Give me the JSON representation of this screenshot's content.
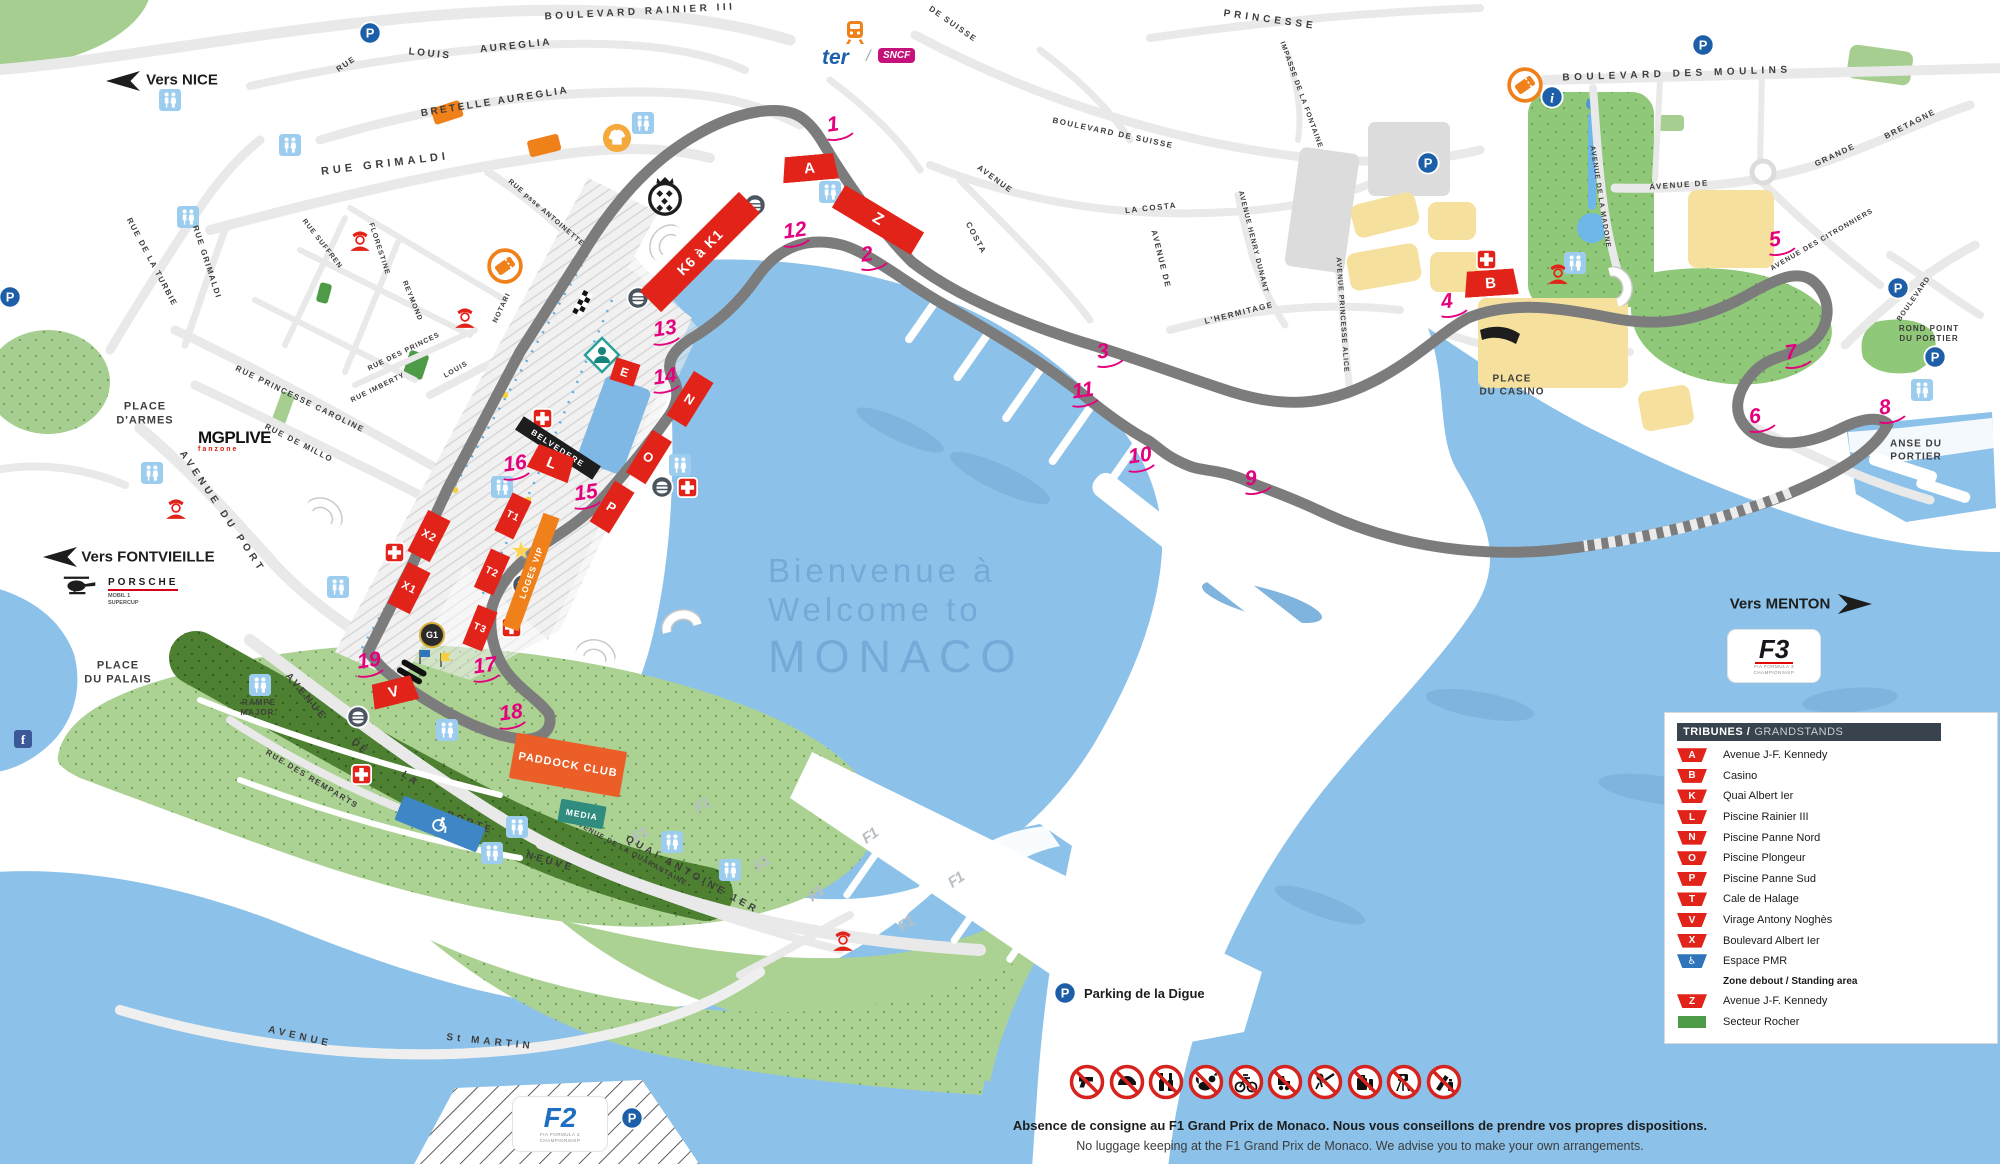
{
  "welcome": {
    "line1": "Bienvenue à",
    "line2": "Welcome to",
    "line3": "MONACO"
  },
  "directions": {
    "nice": "Vers NICE",
    "fontvieille": "Vers FONTVIEILLE",
    "menton": "Vers MENTON"
  },
  "streets": {
    "rainier": "BOULEVARD RAINIER III",
    "rue": "RUE",
    "louis": "LOUIS",
    "aureglia": "AUREGLIA",
    "bretelle": "BRETELLE AUREGLIA",
    "grimaldi": "RUE GRIMALDI",
    "turbie": "RUE DE LA TURBIE",
    "grimaldi2": "RUE GRIMALDI",
    "suffren": "RUE SUFFREN",
    "florestine": "FLORESTINE",
    "reymond": "REYMOND",
    "antoinette": "RUE psse ANTOINETTE",
    "louis2": "LOUIS",
    "notari": "NOTARI",
    "princes": "RUE DES PRINCES",
    "imberty": "RUE IMBERTY",
    "caroline": "RUE PRINCESSE CAROLINE",
    "millo": "RUE DE MILLO",
    "port": "AVENUE DU PORT",
    "porteneuve1": "AVENUE",
    "porteneuve2": "DE",
    "porteneuve3": "LA",
    "porteneuve4": "PORTE",
    "porteneuve5": "NEUVE",
    "remparts": "RUE DES REMPARTS",
    "quai": "QUAI ANTOINE 1ER",
    "quarantaine": "AVENUE DE LA QUARANTAINE",
    "avenue2": "AVENUE",
    "stmartin": "St MARTIN",
    "princesse": "PRINCESSE",
    "impasse": "IMPASSE DE LA FONTAINE",
    "suisse1": "DE SUISSE",
    "suisse2": "BOULEVARD DE SUISSE",
    "costa_av": "AVENUE",
    "costa": "COSTA",
    "lacosta": "LA COSTA",
    "avenuede": "AVENUE DE",
    "dunant": "AVENUE HENRY DUNANT",
    "hermitage": "L'HERMITAGE",
    "alice": "AVENUE PRINCESSE ALICE",
    "moulins": "BOULEVARD DES MOULINS",
    "madone": "AVENUE DE LA MADONE",
    "avenuede2": "AVENUE DE",
    "grande": "GRANDE",
    "bretagne": "BRETAGNE",
    "citronniers": "AVENUE DES CITRONNIERS",
    "larvotto": "BOULEVARD"
  },
  "places": {
    "armes1": "PLACE",
    "armes2": "D'ARMES",
    "palais1": "PLACE",
    "palais2": "DU PALAIS",
    "casino1": "PLACE",
    "casino2": "DU CASINO",
    "rondpoint1": "ROND POINT",
    "rondpoint2": "DU PORTIER",
    "anse1": "ANSE DU",
    "anse2": "PORTIER",
    "rampe1": "RAMPE",
    "rampe2": "MAJOR."
  },
  "stands": {
    "a": "A",
    "b": "B",
    "e": "E",
    "k": "K6 à K1",
    "l": "L",
    "n": "N",
    "o": "O",
    "p": "P",
    "t1": "T1",
    "t2": "T2",
    "t3": "T3",
    "x1": "X1",
    "x2": "X2",
    "v": "V",
    "z": "Z",
    "g1": "G1",
    "loges": "LOGES VIP",
    "belvedere": "BELVEDERE"
  },
  "zones": {
    "paddock": "PADDOCK CLUB",
    "media": "MEDIA"
  },
  "corners": [
    "1",
    "2",
    "3",
    "4",
    "5",
    "6",
    "7",
    "8",
    "9",
    "10",
    "11",
    "12",
    "13",
    "14",
    "15",
    "16",
    "17",
    "18",
    "19"
  ],
  "legend": {
    "title_fr": "TRIBUNES /",
    "title_en": "GRANDSTANDS",
    "grandstands": [
      {
        "code": "A",
        "label": "Avenue J-F. Kennedy",
        "type": "red"
      },
      {
        "code": "B",
        "label": "Casino",
        "type": "red"
      },
      {
        "code": "K",
        "label": "Quai Albert Ier",
        "type": "red"
      },
      {
        "code": "L",
        "label": "Piscine Rainier III",
        "type": "red"
      },
      {
        "code": "N",
        "label": "Piscine Panne Nord",
        "type": "red"
      },
      {
        "code": "O",
        "label": "Piscine Plongeur",
        "type": "red"
      },
      {
        "code": "P",
        "label": "Piscine Panne Sud",
        "type": "red"
      },
      {
        "code": "T",
        "label": "Cale de Halage",
        "type": "red"
      },
      {
        "code": "V",
        "label": "Virage Antony Noghès",
        "type": "red"
      },
      {
        "code": "X",
        "label": "Boulevard Albert Ier",
        "type": "red"
      },
      {
        "code": "♿",
        "label": "Espace PMR",
        "type": "pmr"
      }
    ],
    "standing_title": "Zone debout / Standing area",
    "standing": [
      {
        "code": "Z",
        "label": "Avenue J-F. Kennedy",
        "type": "red"
      },
      {
        "code": "",
        "label": "Secteur Rocher",
        "type": "green"
      }
    ]
  },
  "logos": {
    "mgp": "MGPLIVE",
    "mgp_sub": "fanzone",
    "porsche": "PORSCHE",
    "porsche_sub1": "MOBIL 1",
    "porsche_sub2": "SUPERCUP",
    "ter": "ter",
    "sncf": "SNCF",
    "f1": "F1",
    "f2": "F2",
    "f2_sub1": "FIA FORMULA 2",
    "f2_sub2": "CHAMPIONSHIP",
    "f3": "F3",
    "f3_sub1": "FIA FORMULA 3",
    "f3_sub2": "CHAMPIONSHIP"
  },
  "labels": {
    "parking_digue": "Parking de la Digue",
    "star": "★"
  },
  "notes": {
    "fr": "Absence de consigne au F1 Grand Prix de Monaco. Nous vous conseillons de prendre vos propres dispositions.",
    "en": "No luggage keeping at the F1 Grand Prix de Monaco. We advise you to make your own arrangements."
  },
  "prohibited": [
    "weapons",
    "helmets",
    "glass bottles",
    "animals",
    "bicycles and scooters",
    "rollerblades",
    "selfie sticks",
    "luggage",
    "camera tripods",
    "knives and aerosols"
  ]
}
